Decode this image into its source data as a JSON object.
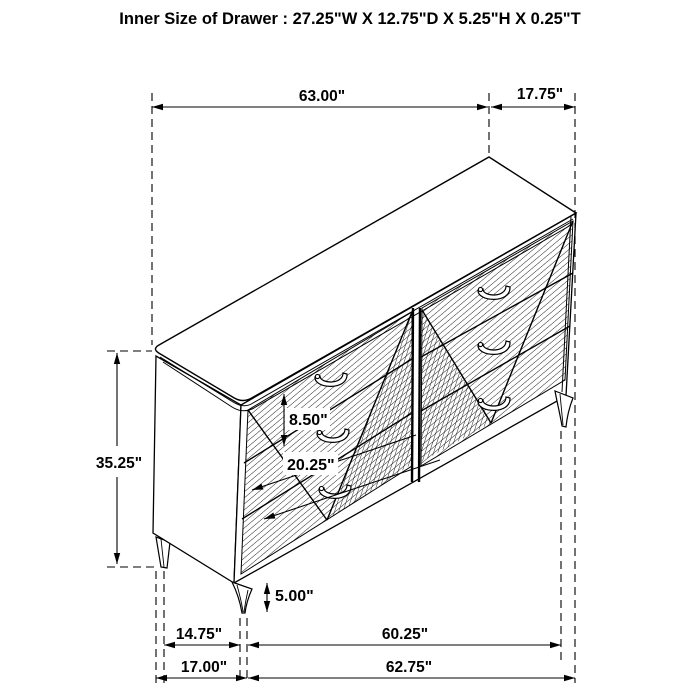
{
  "title": "Inner Size of Drawer : 27.25\"W X 12.75\"D X 5.25\"H X 0.25\"T",
  "figure": {
    "item": "6-drawer dresser perspective line drawing",
    "line_color": "#000000",
    "background": "#ffffff"
  },
  "dims": {
    "top_width": "63.00\"",
    "top_depth": "17.75\"",
    "height": "35.25\"",
    "drawer_height": "8.50\"",
    "drawer_width": "20.25\"",
    "leg_height": "5.00\"",
    "leg_inset_left": "14.75\"",
    "leg_span": "60.25\"",
    "base_left": "17.00\"",
    "base_width": "62.75\""
  }
}
